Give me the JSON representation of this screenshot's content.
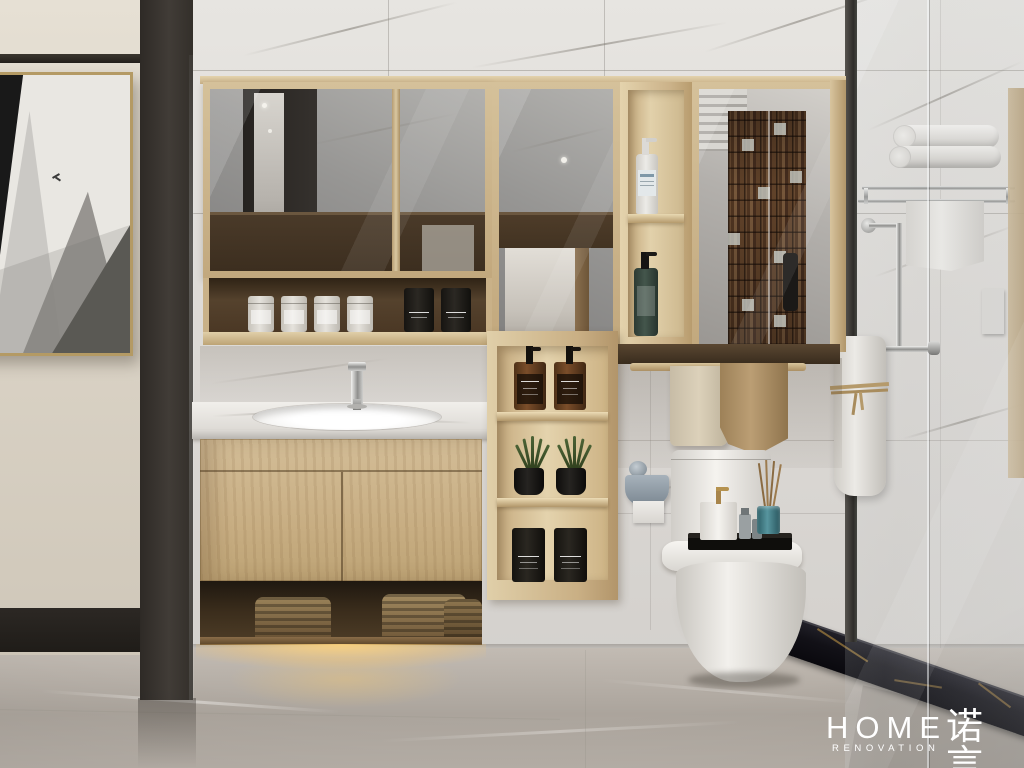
{
  "meta": {
    "room_type": "bathroom",
    "style": "modern interior 3D render"
  },
  "logo": {
    "main": "HOME",
    "sub": "RENOVATION",
    "cn": "诺言"
  },
  "objects": [
    "framed abstract artwork",
    "dark partition pillar",
    "mirrored wall cabinet",
    "open shelf with toiletry jars",
    "tall open shelf with lotion bottles",
    "wood vanity with marble counter",
    "chrome faucet",
    "under-cabinet warm light",
    "open shelf column with amber bottles, plants and black candles",
    "one-piece toilet with black amenity tray",
    "toilet paper holder",
    "hanging towels on wood rail",
    "chrome towel shelf with rolled towels",
    "glass shower partition",
    "black marble shower threshold",
    "marble tile wall",
    "gray marble floor"
  ],
  "palette": {
    "wall-cream": "#ddd6c9",
    "trim-dark": "#2b2723",
    "art-paper": "#e9e7e2",
    "frame-gold": "#b49a64",
    "pillar": "#37322d",
    "marble-light": "#e4e2de",
    "marble-vein": "#a8a49d",
    "wood-light": "#d8c6a0",
    "wood-mid": "#c5ab80",
    "wood-dark": "#54402c",
    "mirror-gray": "#979694",
    "counter-white": "#edebe7",
    "floor-gray": "#aaa39b",
    "glow-warm": "#f4cf8a",
    "toilet-white": "#f0eeea",
    "towel-cream": "#d8cdb5",
    "towel-tan": "#b1946c",
    "towel-white": "#e9e7e3",
    "mosaic-brown": "#6b4b31",
    "teal-jar": "#3f7d85",
    "green-bottle": "#3a4f45",
    "amber-bottle": "#6e4728",
    "black-object": "#1d1b18",
    "curb-black": "#15141a",
    "curb-vein": "#a5813f",
    "logo-white": "#ffffff"
  }
}
